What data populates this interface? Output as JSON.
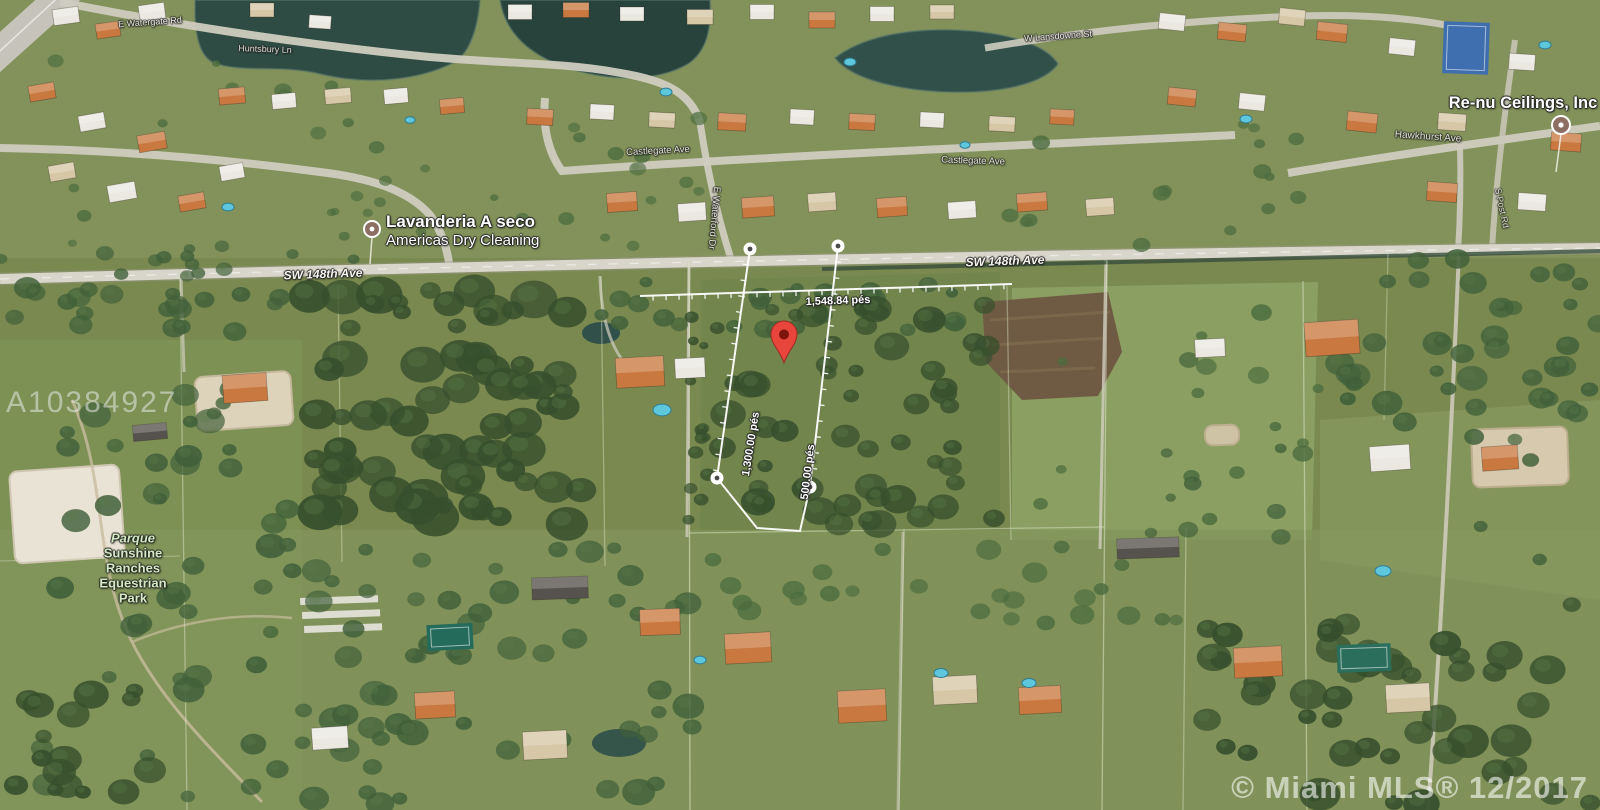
{
  "map": {
    "watermark": "A10384927",
    "attribution": "© Miami MLS® 12/2017",
    "colors": {
      "pin": "#e8453c",
      "poi_icon": "#8d6e63",
      "boundary": "#ffffff",
      "park_text": "#d3e9c2"
    },
    "pois": [
      {
        "line1": "Lavanderia A seco",
        "line2": "Americas Dry Cleaning"
      },
      {
        "label": "Re-nu Ceilings, Inc"
      }
    ],
    "park": {
      "lines": [
        "Parque",
        "Sunshine",
        "Ranches",
        "Equestrian",
        "Park"
      ]
    },
    "streets": {
      "sw148_left": "SW 148th Ave",
      "sw148_right": "SW 148th Ave",
      "castlegate_left": "Castlegate Ave",
      "castlegate_right": "Castlegate Ave",
      "waterford": "E Waterford Dr",
      "hawkhurst": "Hawkhurst Ave",
      "huntsbury": "Huntsbury Ln",
      "watergate": "E Watergate Rd",
      "lansdowne": "W Lansdowne St",
      "post": "S Post Rd"
    },
    "measurements": {
      "frontage": "1,548.84 pés",
      "west_side": "1,300.00 pés",
      "east_side": "500.00 pés"
    }
  }
}
